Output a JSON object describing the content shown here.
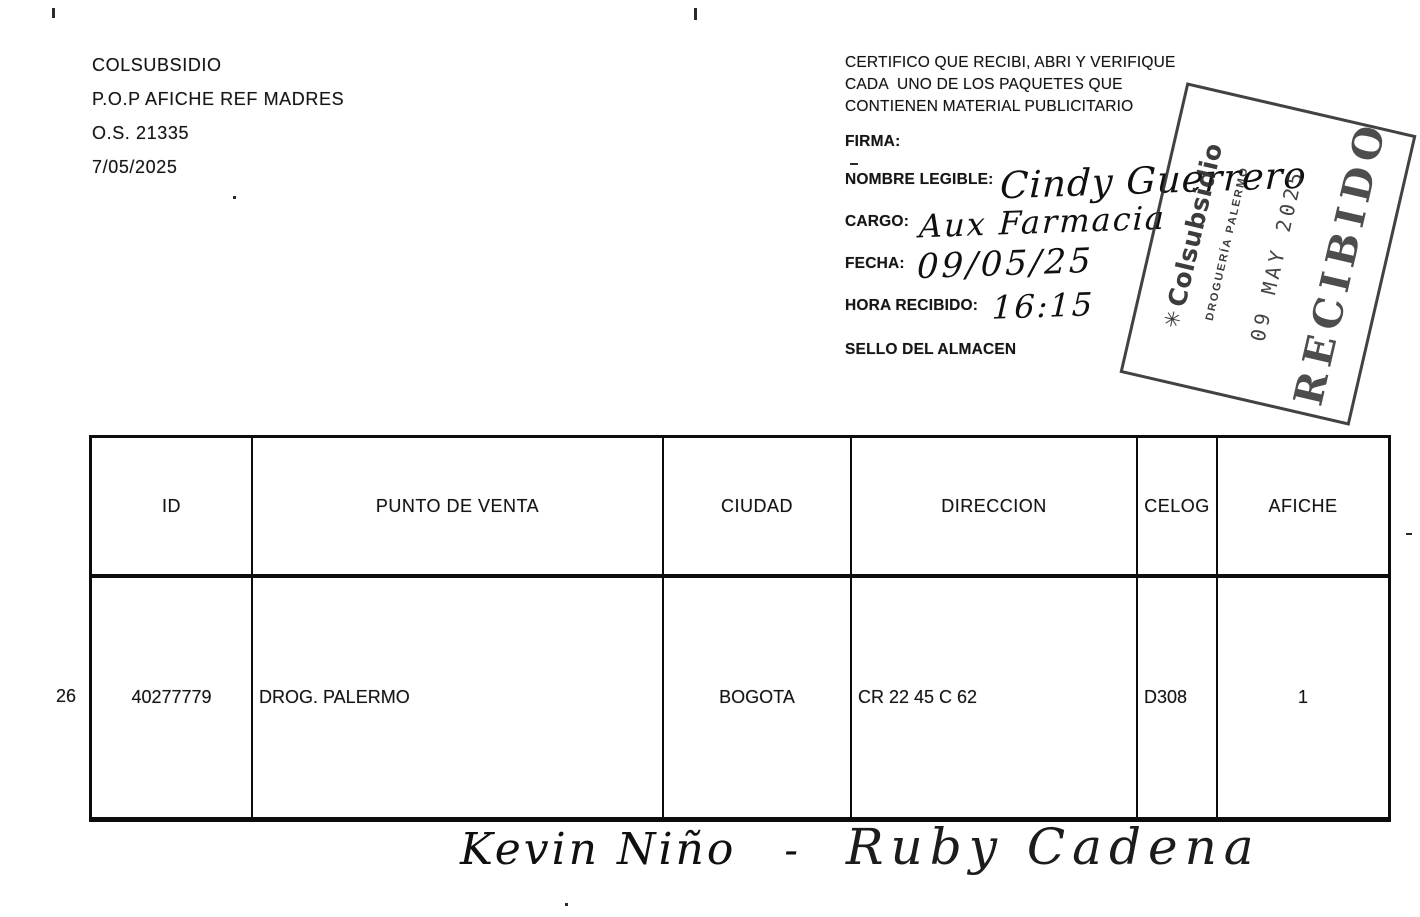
{
  "page": {
    "header": {
      "org": "COLSUBSIDIO",
      "campaign": "P.O.P AFICHE REF MADRES",
      "order": "O.S. 21335",
      "date": "7/05/2025"
    },
    "certification": {
      "lines": [
        "CERTIFICO QUE RECIBI, ABRI Y VERIFIQUE",
        "CADA  UNO DE LOS PAQUETES QUE",
        "CONTIENEN MATERIAL PUBLICITARIO"
      ],
      "firma_label": "FIRMA:",
      "nombre_label": "NOMBRE LEGIBLE:",
      "nombre_value": "Cindy Guerrero",
      "cargo_label": "CARGO:",
      "cargo_value": "Aux Farmacia",
      "fecha_label": "FECHA:",
      "fecha_value": "09/05/25",
      "hora_label": "HORA RECIBIDO:",
      "hora_value": "16:15",
      "sello_label": "SELLO DEL ALMACEN"
    },
    "stamp": {
      "brand_mark": "✳",
      "brand": "Colsubsidio",
      "location": "DROGUERÍA PALERMO",
      "date": "09 MAY 2025",
      "status": "RECIBIDO"
    },
    "table": {
      "row_number": "26",
      "headers": [
        "ID",
        "PUNTO DE VENTA",
        "CIUDAD",
        "DIRECCION",
        "CELOG",
        "AFICHE"
      ],
      "row": {
        "id": "40277779",
        "punto": "DROG. PALERMO",
        "ciudad": "BOGOTA",
        "direccion": "CR 22 45 C 62",
        "celog": "D308",
        "afiche": "1"
      }
    },
    "signature": {
      "name1": "Kevin Niño",
      "dash": "-",
      "name2": "Ruby Cadena"
    }
  }
}
